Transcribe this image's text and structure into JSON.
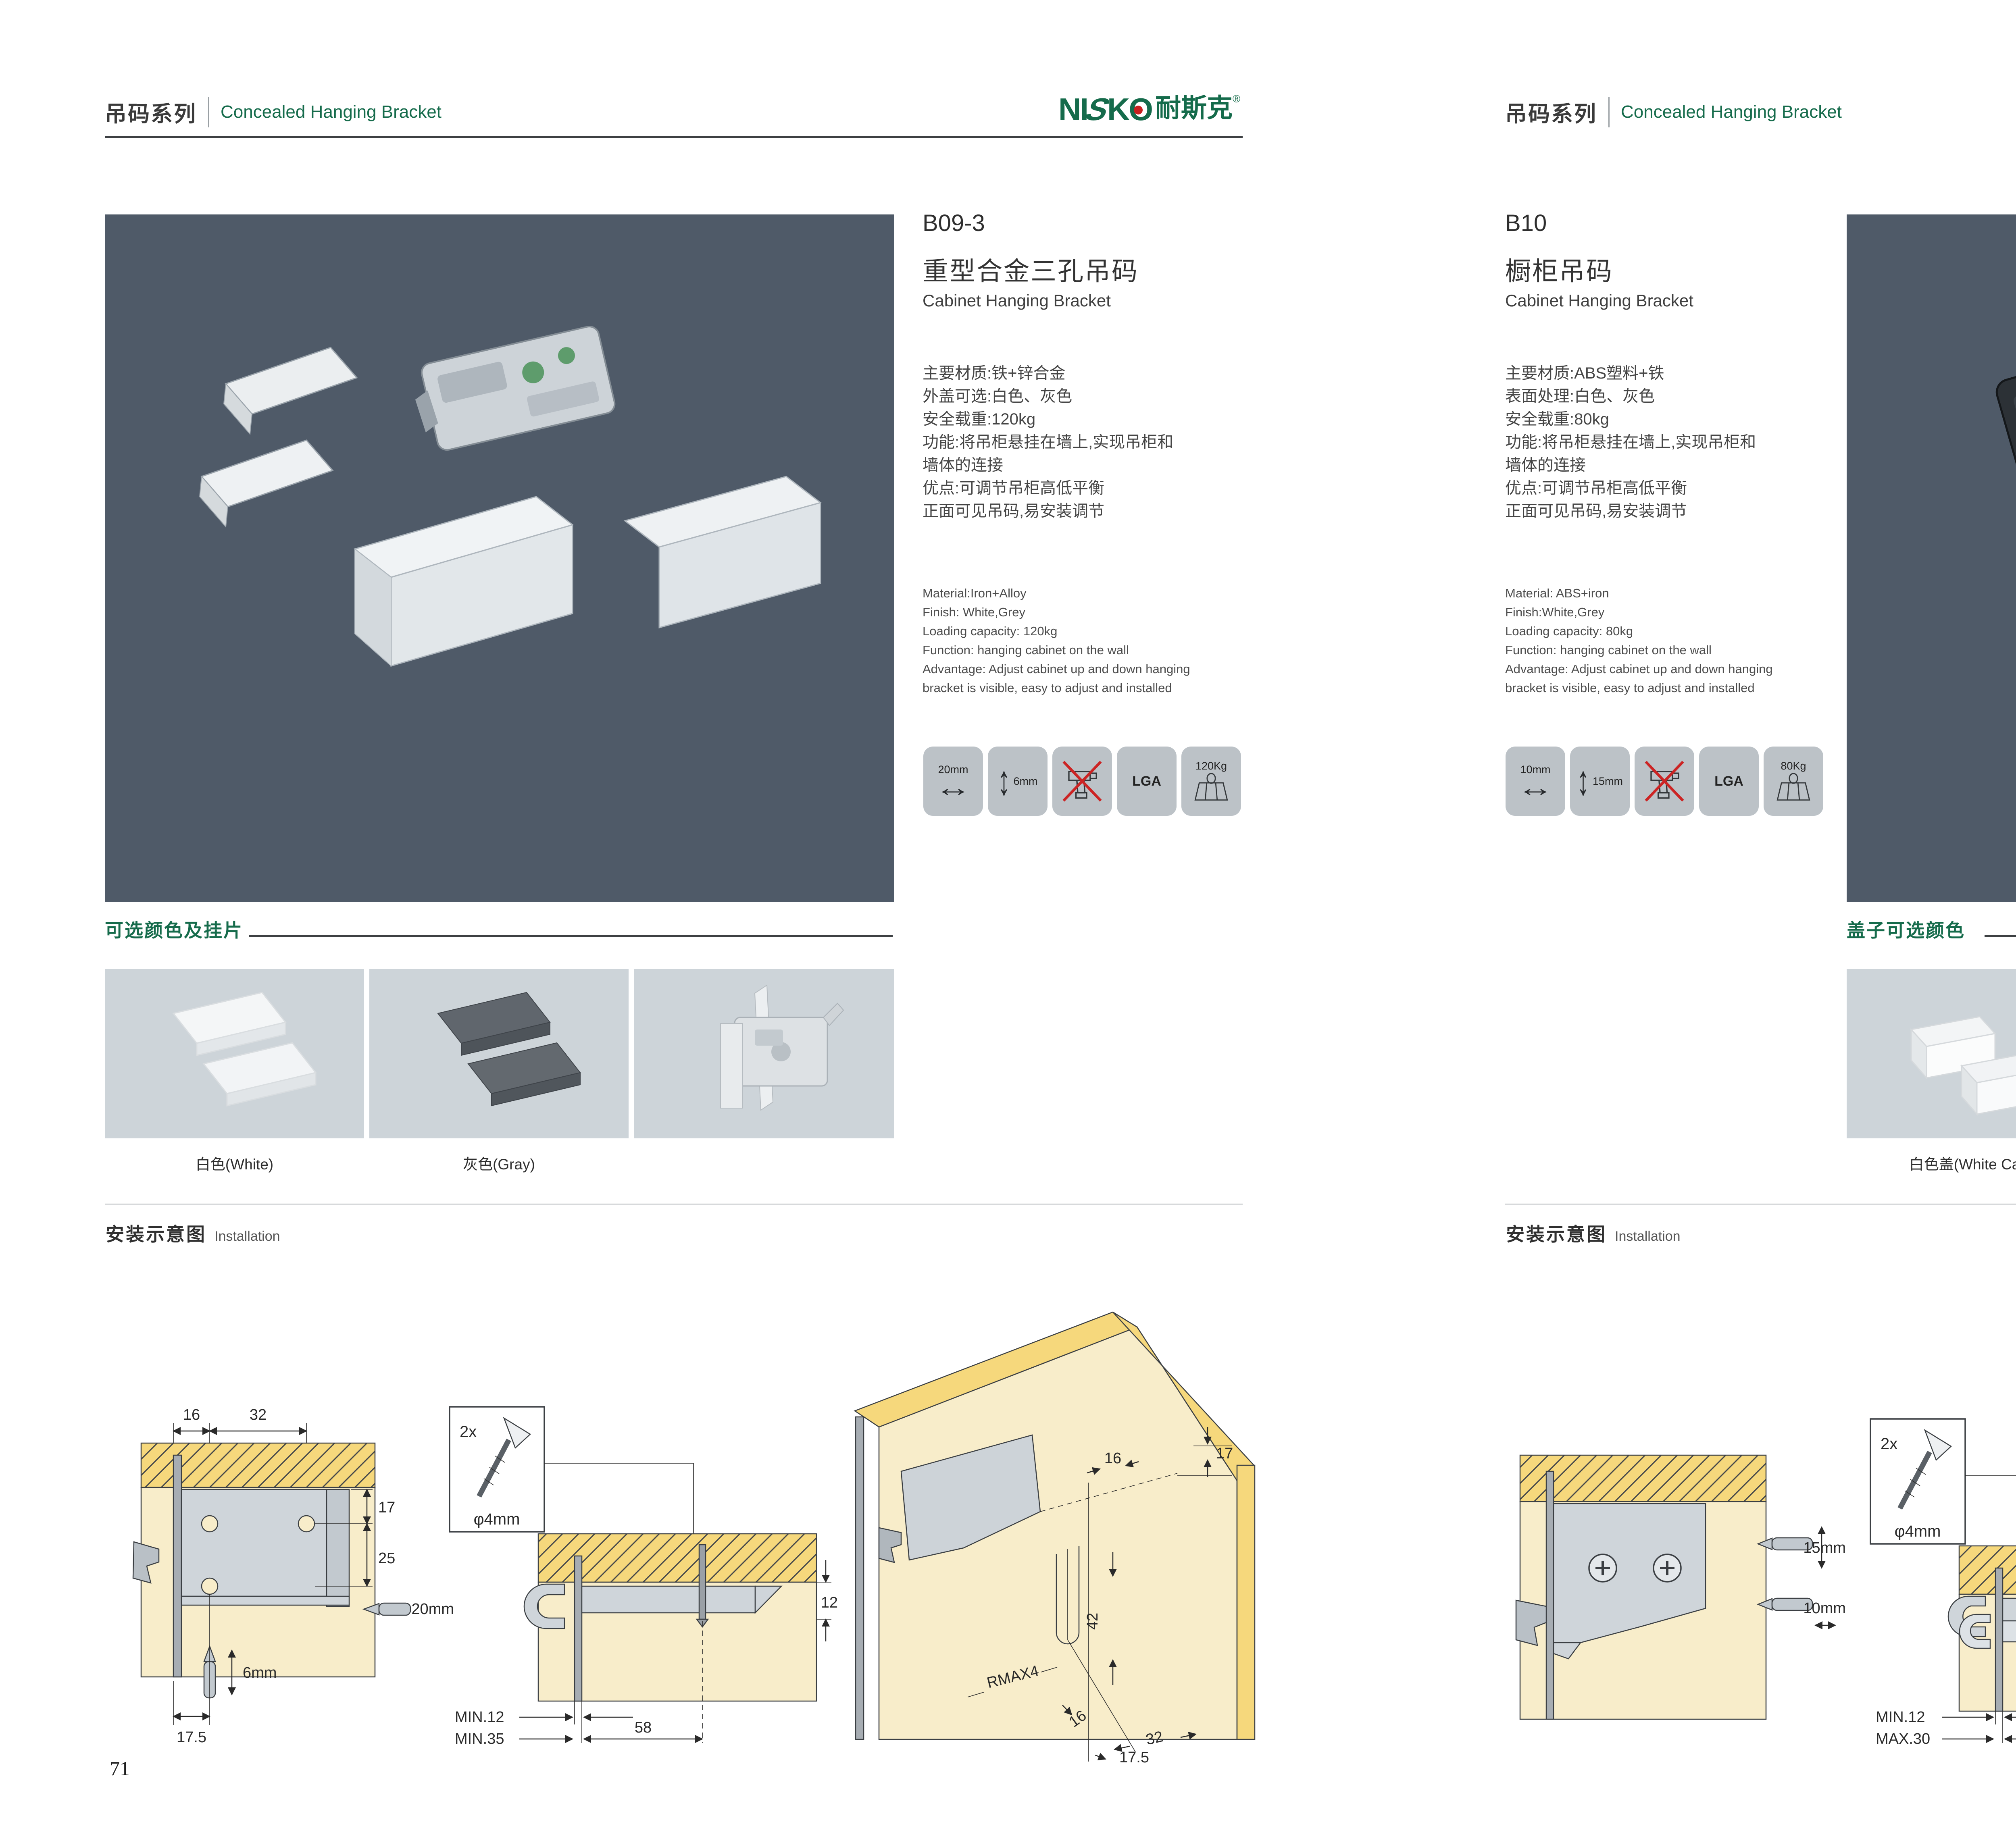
{
  "brand": {
    "parts": [
      "NI",
      "S",
      "K",
      "O"
    ],
    "cn": "耐斯克",
    "reg": "®"
  },
  "pages": [
    {
      "header": {
        "series_zh": "吊码系列",
        "series_en": "Concealed Hanging Bracket"
      },
      "product": {
        "model": "B09-3",
        "name_zh": "重型合金三孔吊码",
        "name_en": "Cabinet Hanging Bracket",
        "specs_zh": [
          "主要材质:铁+锌合金",
          "外盖可选:白色、灰色",
          "安全载重:120kg",
          "功能:将吊柜悬挂在墙上,实现吊柜和",
          "墙体的连接",
          "优点:可调节吊柜高低平衡",
          "正面可见吊码,易安装调节"
        ],
        "specs_en": [
          "Material:Iron+Alloy",
          "Finish: White,Grey",
          "Loading capacity: 120kg",
          "Function: hanging cabinet on the wall",
          "Advantage: Adjust cabinet up and down hanging",
          "bracket is visible, easy to adjust and installed"
        ],
        "icons": [
          {
            "label": "20mm"
          },
          {
            "label": "6mm"
          },
          {
            "label": ""
          },
          {
            "label": "LGA"
          },
          {
            "label": "120Kg"
          }
        ]
      },
      "colors": {
        "heading": "可选颜色及挂片",
        "labels": [
          "白色(White)",
          "灰色(Gray)"
        ]
      },
      "installation": {
        "heading_zh": "安装示意图",
        "heading_en": "Installation",
        "front": {
          "top1": "16",
          "top2": "32",
          "right1": "17",
          "right2": "25",
          "bit_h": "20mm",
          "bit_v": "6mm",
          "bottom": "17.5"
        },
        "side": {
          "qty": "2x",
          "dia": "φ4mm",
          "right": "12",
          "b1": "MIN.12",
          "b2": "MIN.35",
          "span": "58"
        },
        "persp": {
          "a": "17",
          "b": "16",
          "c": "42",
          "d": "RMAX4",
          "e": "16",
          "f": "32",
          "g": "17.5"
        }
      },
      "page_number": "71"
    },
    {
      "header": {
        "series_zh": "吊码系列",
        "series_en": "Concealed Hanging Bracket"
      },
      "product": {
        "model": "B10",
        "name_zh": "橱柜吊码",
        "name_en": "Cabinet Hanging Bracket",
        "specs_zh": [
          "主要材质:ABS塑料+铁",
          "表面处理:白色、灰色",
          "安全载重:80kg",
          "功能:将吊柜悬挂在墙上,实现吊柜和",
          "墙体的连接",
          "优点:可调节吊柜高低平衡",
          "正面可见吊码,易安装调节"
        ],
        "specs_en": [
          "Material: ABS+iron",
          "Finish:White,Grey",
          "Loading capacity: 80kg",
          "Function: hanging cabinet on the wall",
          "Advantage: Adjust cabinet up and down hanging",
          "bracket is visible, easy to adjust and installed"
        ],
        "icons": [
          {
            "label": "10mm"
          },
          {
            "label": "15mm"
          },
          {
            "label": ""
          },
          {
            "label": "LGA"
          },
          {
            "label": "80Kg"
          }
        ]
      },
      "colors": {
        "heading": "盖子可选颜色",
        "labels": [
          "白色盖(White Cap)",
          "灰色盖(Gray Cap)"
        ]
      },
      "installation": {
        "heading_zh": "安装示意图",
        "heading_en": "Installation",
        "front": {
          "bit_v": "15mm",
          "bit_h": "10mm"
        },
        "side": {
          "qty": "2x",
          "dia": "φ4mm",
          "right": "18",
          "b1": "MIN.12",
          "b2": "MAX.30",
          "span": "67"
        },
        "persp": {
          "a": "13",
          "c": "42",
          "d": "RMAX4",
          "e": "19",
          "f": "17",
          "g": "32"
        }
      },
      "page_number": "72"
    }
  ]
}
